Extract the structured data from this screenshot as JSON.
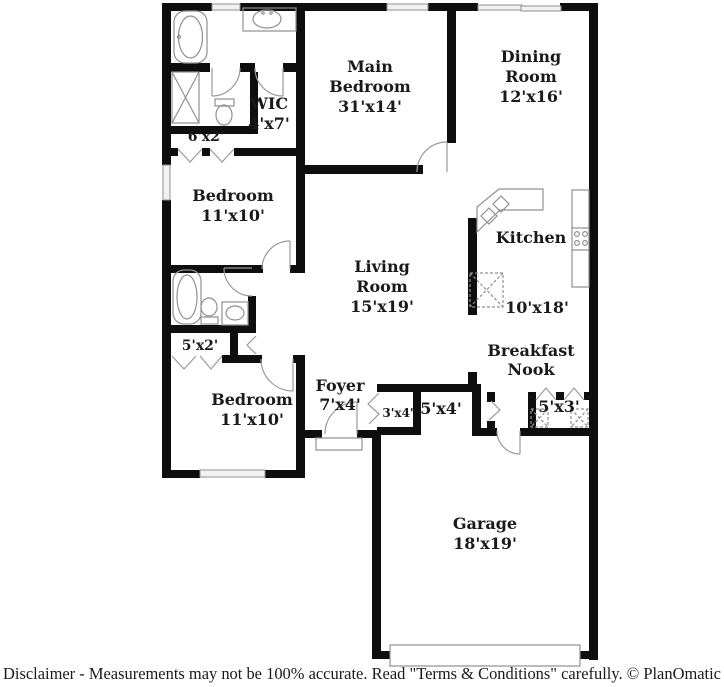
{
  "rooms": {
    "main_bedroom": {
      "line1": "Main",
      "line2": "Bedroom",
      "dims": "31'x14'"
    },
    "dining_room": {
      "line1": "Dining",
      "line2": "Room",
      "dims": "12'x16'"
    },
    "living_room": {
      "line1": "Living",
      "line2": "Room",
      "dims": "15'x19'"
    },
    "kitchen": {
      "line1": "Kitchen",
      "dims": "10'x18'"
    },
    "breakfast_nook": {
      "line1": "Breakfast",
      "line2": "Nook"
    },
    "bedroom_upper": {
      "line1": "Bedroom",
      "dims": "11'x10'"
    },
    "bedroom_lower": {
      "line1": "Bedroom",
      "dims": "11'x10'"
    },
    "wic": {
      "line1": "WIC",
      "dims": "4'x7'"
    },
    "foyer": {
      "line1": "Foyer",
      "dims": "7'x4'"
    },
    "garage": {
      "line1": "Garage",
      "dims": "18'x19'"
    }
  },
  "closets": {
    "hall_closet_6x2": {
      "dims": "6'x2'"
    },
    "hall_closet_5x2": {
      "dims": "5'x2'"
    },
    "foyer_closet_3x4": {
      "dims": "3'x4'"
    },
    "garage_nook_5x4": {
      "dims": "5'x4'"
    },
    "laundry_closet_5x3": {
      "dims": "5'x3'"
    }
  },
  "footer": {
    "disclaimer": "Disclaimer - Measurements may not be 100% accurate. Read \"Terms & Conditions\" carefully. © PlanOmatic"
  },
  "colors": {
    "wall": "#0e0e0e",
    "fixture_line": "#909090",
    "door_line": "#9a9a9a",
    "window_fill": "#f2f2f2",
    "text": "#1a1a1a"
  }
}
